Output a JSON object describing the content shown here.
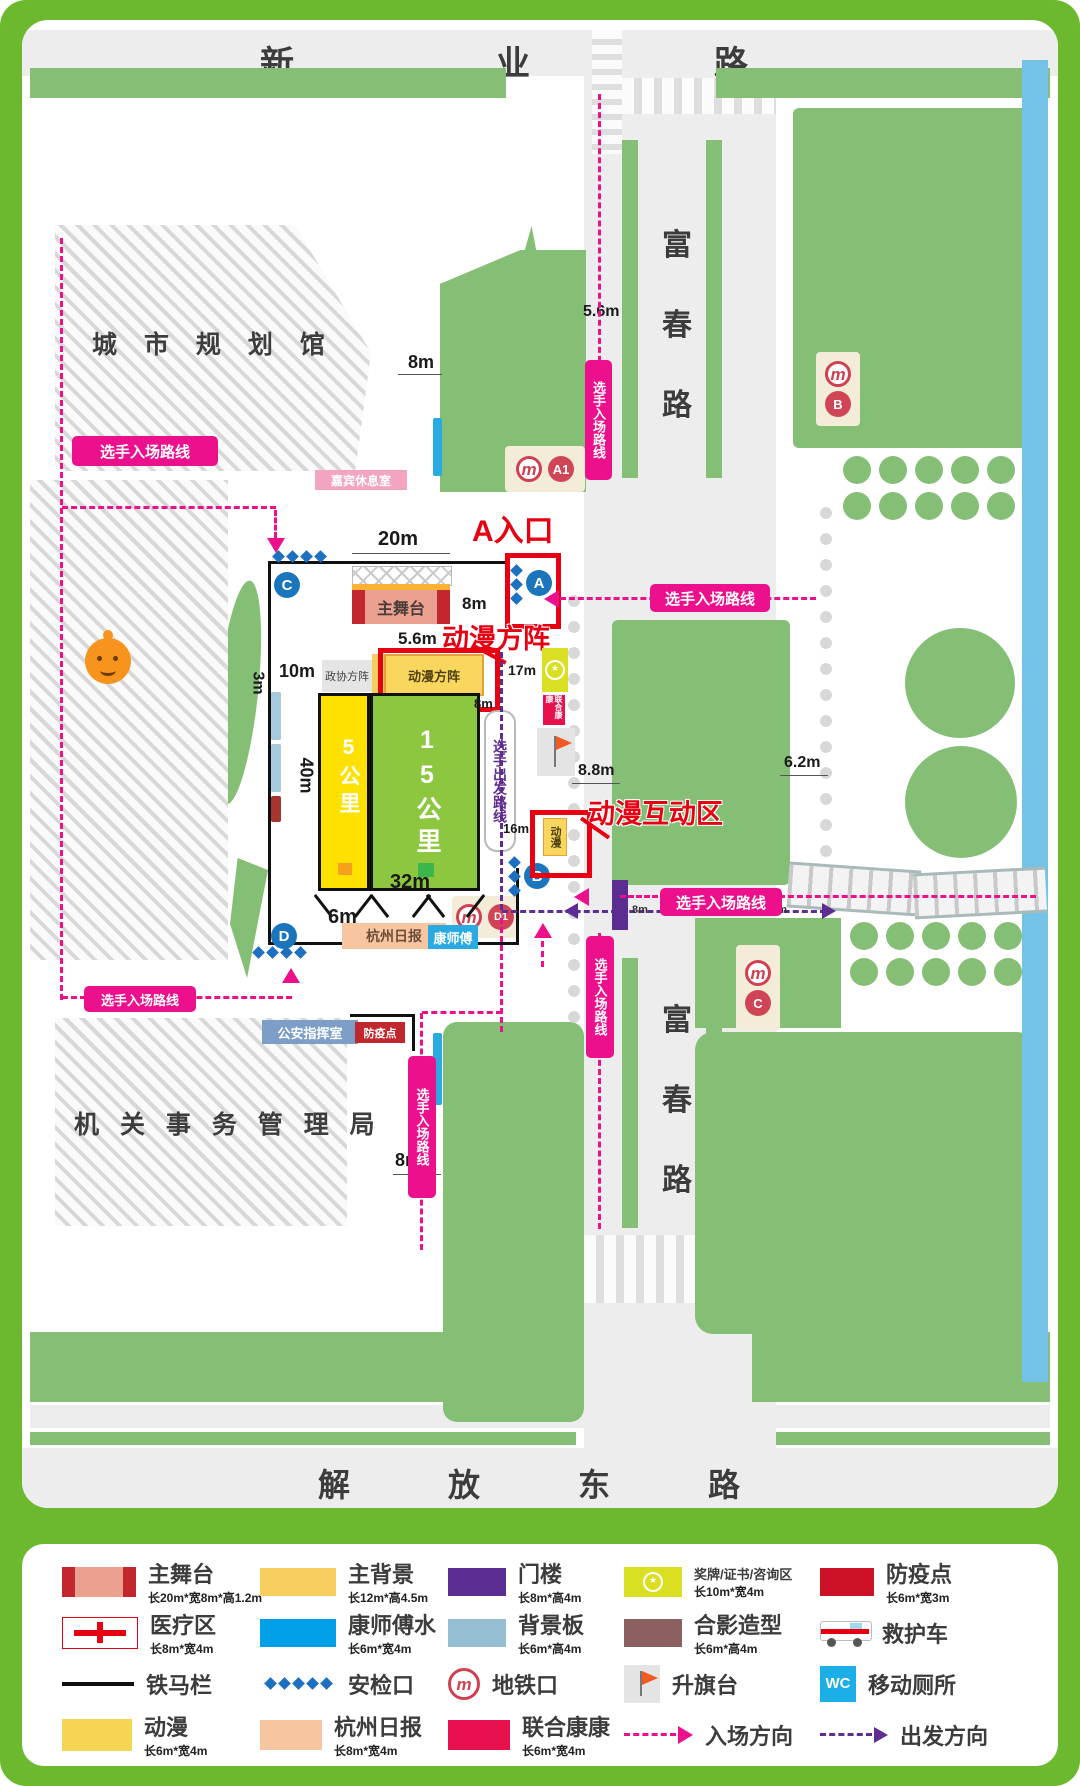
{
  "streets": {
    "top": [
      "新",
      "业",
      "路"
    ],
    "fuchun": [
      "富",
      "春",
      "路"
    ],
    "bottom": [
      "解",
      "放",
      "东",
      "路"
    ]
  },
  "buildings": {
    "planning": "城 市 规 划 馆",
    "admin": "机 关 事 务 管 理 局",
    "vip": "嘉宾休息室",
    "police": "公安指挥室",
    "epidemic": "防疫点"
  },
  "venue": {
    "stage": "主舞台",
    "zhengxie": "政协方阵",
    "squad": "动漫方阵",
    "km5": "5公里",
    "km15": "15公里",
    "daily": "杭州日报",
    "kang": "康师傅",
    "anime": "动漫",
    "union": "联合康康"
  },
  "callouts": {
    "a_entrance": "A入口",
    "anime_squad": "动漫方阵",
    "anime_zone": "动漫互动区"
  },
  "routes": {
    "entry": "选手入场路线",
    "depart": "选手出发路线"
  },
  "markers": {
    "a": "A",
    "b": "B",
    "c": "C",
    "d": "D"
  },
  "stations": {
    "a1": "A1",
    "b": "B",
    "c": "C",
    "d1": "D1"
  },
  "icons": {
    "metro": "m",
    "wc": "WC",
    "star": "★"
  },
  "dims": {
    "d20": "20m",
    "d8_stage": "8m",
    "d56_stage": "5.6m",
    "d10": "10m",
    "d3": "3m",
    "d40": "40m",
    "d17": "17m",
    "d8_route": "8m",
    "d16": "16m",
    "d32": "32m",
    "d6": "6m",
    "d88": "8.8m",
    "d62": "6.2m",
    "d8_nw": "8m",
    "d56_nw": "5.6m",
    "d8_cross": "8m",
    "d56_cross": "5.6m",
    "d8_sw": "8m"
  },
  "legend": {
    "items": [
      {
        "label": "主舞台",
        "sub": "长20m*宽8m*高1.2m"
      },
      {
        "label": "主背景",
        "sub": "长12m*高4.5m"
      },
      {
        "label": "门楼",
        "sub": "长8m*高4m"
      },
      {
        "label": "奖牌/证书/咨询区",
        "sub": "长10m*宽4m"
      },
      {
        "label": "防疫点",
        "sub": "长6m*宽3m"
      },
      {
        "label": "医疗区",
        "sub": "长8m*宽4m"
      },
      {
        "label": "康师傅水",
        "sub": "长6m*宽4m"
      },
      {
        "label": "背景板",
        "sub": "长6m*高4m"
      },
      {
        "label": "合影造型",
        "sub": "长6m*高4m"
      },
      {
        "label": "救护车",
        "sub": ""
      },
      {
        "label": "铁马栏",
        "sub": ""
      },
      {
        "label": "安检口",
        "sub": ""
      },
      {
        "label": "地铁口",
        "sub": ""
      },
      {
        "label": "升旗台",
        "sub": ""
      },
      {
        "label": "移动厕所",
        "sub": ""
      },
      {
        "label": "动漫",
        "sub": "长6m*宽4m"
      },
      {
        "label": "杭州日报",
        "sub": "长8m*宽4m"
      },
      {
        "label": "联合康康",
        "sub": "长6m*宽4m"
      },
      {
        "label": "入场方向",
        "sub": ""
      },
      {
        "label": "出发方向",
        "sub": ""
      }
    ]
  }
}
